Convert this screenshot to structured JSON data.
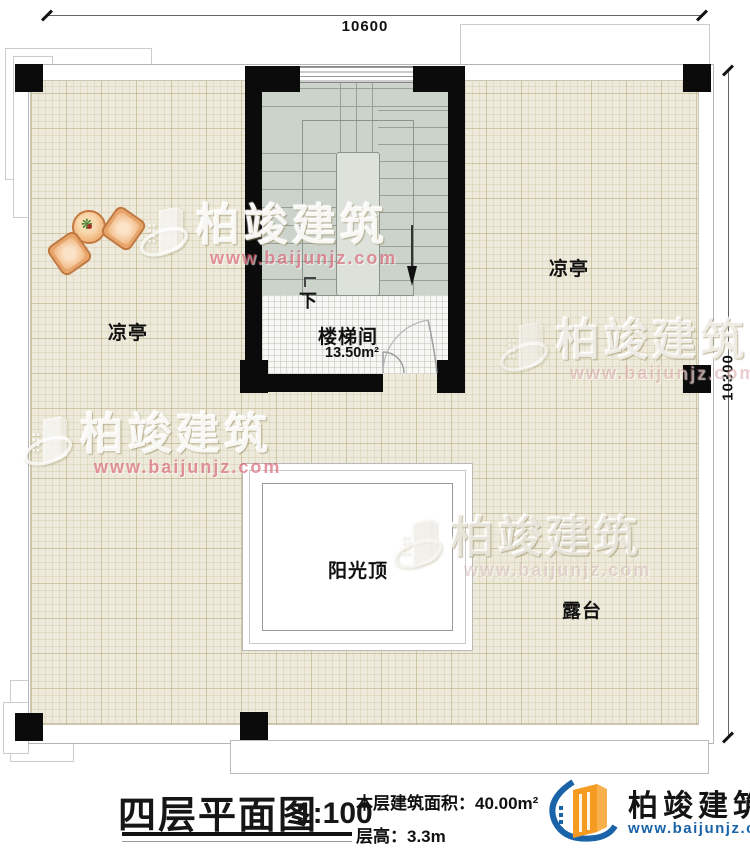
{
  "plan": {
    "dim_top": "10600",
    "dim_right": "10300",
    "rooms": {
      "stairwell": {
        "label": "楼梯间",
        "area": "13.50m²",
        "direction": "下"
      },
      "pavilion_left": {
        "label": "凉亭"
      },
      "pavilion_right": {
        "label": "凉亭"
      },
      "skylight": {
        "label": "阳光顶"
      },
      "terrace": {
        "label": "露台"
      }
    }
  },
  "watermark": {
    "name": "柏竣建筑",
    "url": "www.baijunjz.com"
  },
  "title_block": {
    "title": "四层平面图",
    "scale": "1:100",
    "floor_area_label": "本层建筑面积：",
    "floor_area_value": "40.00m²",
    "floor_height_label": "层高：",
    "floor_height_value": "3.3m"
  },
  "brand": {
    "name": "柏竣建筑",
    "url": "www.baijunjz.com"
  },
  "colors": {
    "accent_blue": "#1a63a8",
    "accent_orange": "#f59b22",
    "floor_beige": "#eeeadb",
    "stair_green": "#ccd3cb",
    "watermark_red": "#cd3e52"
  }
}
